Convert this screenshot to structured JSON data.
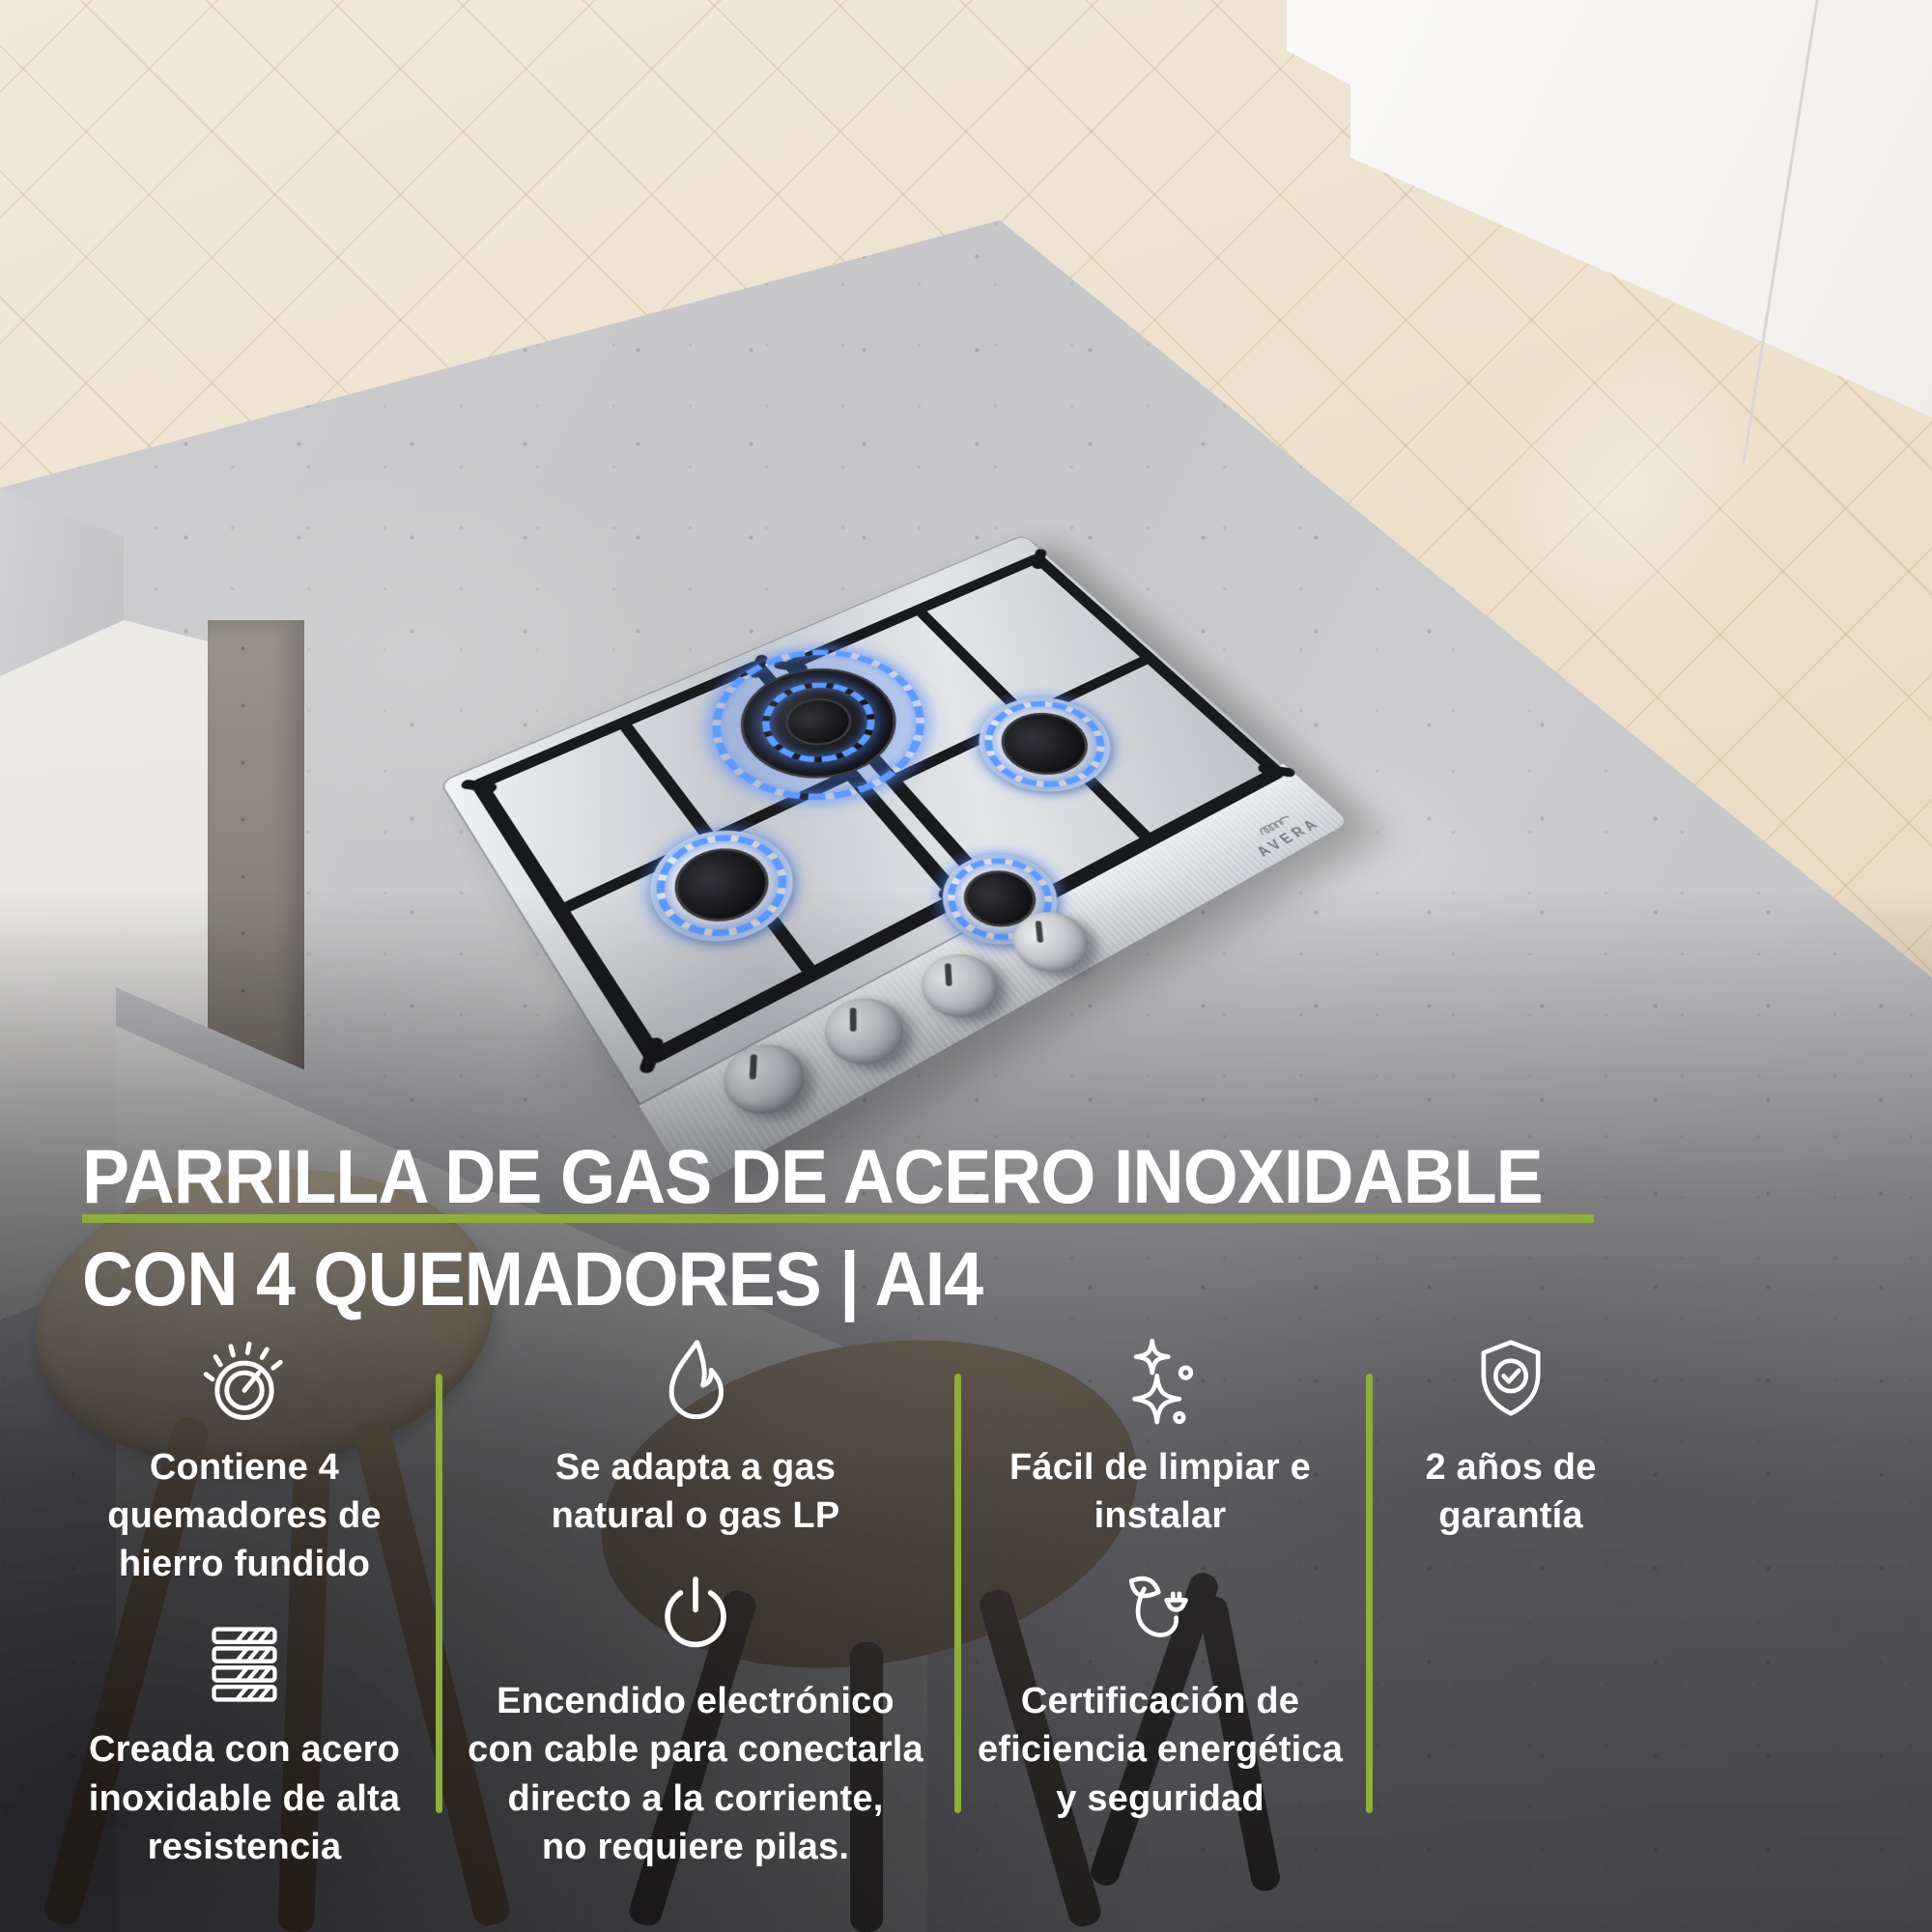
{
  "brand": {
    "name": "AVERA"
  },
  "title": {
    "line1": "PARRILLA DE GAS DE ACERO INOXIDABLE",
    "line2": "CON 4 QUEMADORES | AI4"
  },
  "colors": {
    "accent_green": "#8EAF3C",
    "flame_blue": "#5F9BFF"
  },
  "product": {
    "burner_count": 4,
    "model": "AI4"
  },
  "features": [
    {
      "icon": "burner-knob-icon",
      "text": "Contiene 4\nquemadores de\nhierro fundido"
    },
    {
      "icon": "flame-icon",
      "text": "Se adapta a gas\nnatural o gas LP"
    },
    {
      "icon": "sparkles-icon",
      "text": "Fácil de limpiar e\ninstalar"
    },
    {
      "icon": "shield-check-icon",
      "text": "2 años de\ngarantía"
    },
    {
      "icon": "steel-sheets-icon",
      "text": "Creada con acero\ninoxidable de alta\nresistencia"
    },
    {
      "icon": "power-icon",
      "text": "Encendido electrónico\ncon cable para conectarla\ndirecto a la corriente,\nno requiere pilas."
    },
    {
      "icon": "eco-plug-icon",
      "text": "Certificación de\neficiencia energética\ny seguridad"
    }
  ]
}
